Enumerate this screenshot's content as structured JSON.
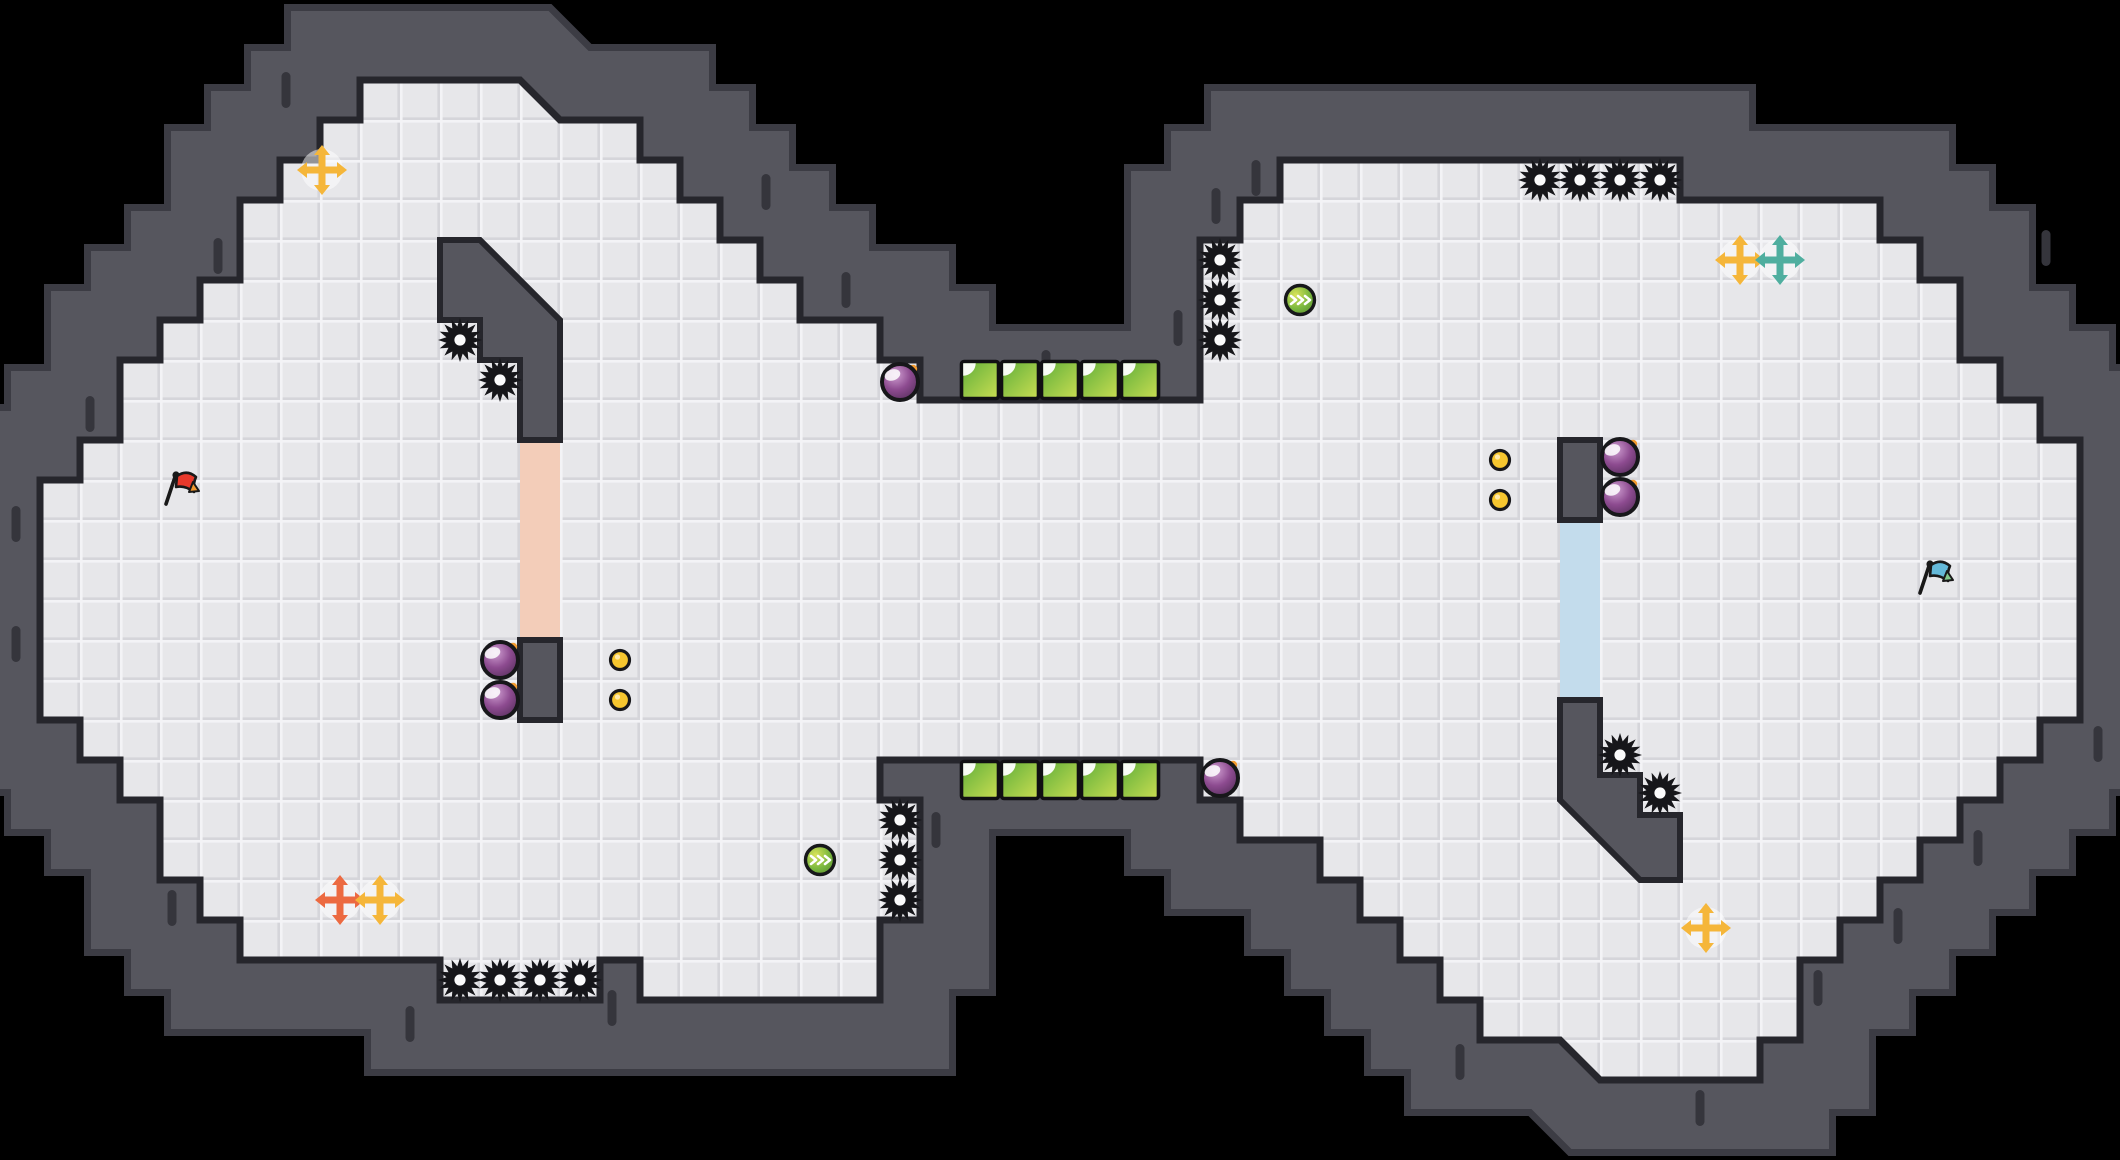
{
  "level": {
    "width": 2120,
    "height": 1160,
    "tile_size": 40,
    "colors": {
      "background": "#000000",
      "wall": "#56565e",
      "wall_rim": "#3c3c44",
      "wall_tick": "#35353c",
      "floor": "#e7e7ea",
      "floor_bevel_light": "#f3f3f6",
      "floor_bevel_dark": "#d5d5da",
      "outline": "#26262c",
      "pink_door": "#f3cdb9",
      "blue_door": "#c3dcec",
      "saw": "#16161a",
      "saw_hole": "#fbfbfc",
      "bomb_body": "#8d4b90",
      "bomb_light": "#cf9ed1",
      "bomb_fuse": "#f49b2e",
      "coin": "#f6c62f",
      "orb_green": "#7ab83e",
      "orb_yellow": "#d9e25a",
      "block_green": "#5fae3a",
      "block_yellow": "#cade52",
      "cross_yellow": "#f5b63a",
      "cross_orange": "#ec6a41",
      "cross_teal": "#4fae9f",
      "flag_red": "#e8392b",
      "flag_red_tip": "#f2982f",
      "flag_blue": "#64b9d9",
      "flag_blue_tip": "#82c98b"
    },
    "floor_polygon": [
      [
        360,
        80
      ],
      [
        520,
        80
      ],
      [
        560,
        120
      ],
      [
        640,
        120
      ],
      [
        640,
        160
      ],
      [
        680,
        160
      ],
      [
        680,
        200
      ],
      [
        720,
        200
      ],
      [
        720,
        240
      ],
      [
        760,
        240
      ],
      [
        760,
        280
      ],
      [
        800,
        280
      ],
      [
        800,
        320
      ],
      [
        880,
        320
      ],
      [
        880,
        360
      ],
      [
        920,
        360
      ],
      [
        920,
        400
      ],
      [
        1200,
        400
      ],
      [
        1200,
        240
      ],
      [
        1240,
        240
      ],
      [
        1240,
        200
      ],
      [
        1280,
        200
      ],
      [
        1280,
        160
      ],
      [
        1680,
        160
      ],
      [
        1680,
        200
      ],
      [
        1880,
        200
      ],
      [
        1880,
        240
      ],
      [
        1920,
        240
      ],
      [
        1920,
        280
      ],
      [
        1960,
        280
      ],
      [
        1960,
        360
      ],
      [
        2000,
        360
      ],
      [
        2000,
        400
      ],
      [
        2040,
        400
      ],
      [
        2040,
        440
      ],
      [
        2080,
        440
      ],
      [
        2080,
        720
      ],
      [
        2040,
        720
      ],
      [
        2040,
        760
      ],
      [
        2000,
        760
      ],
      [
        2000,
        800
      ],
      [
        1960,
        800
      ],
      [
        1960,
        840
      ],
      [
        1920,
        840
      ],
      [
        1920,
        880
      ],
      [
        1880,
        880
      ],
      [
        1880,
        920
      ],
      [
        1840,
        920
      ],
      [
        1840,
        960
      ],
      [
        1800,
        960
      ],
      [
        1800,
        1040
      ],
      [
        1760,
        1040
      ],
      [
        1760,
        1080
      ],
      [
        1600,
        1080
      ],
      [
        1560,
        1040
      ],
      [
        1480,
        1040
      ],
      [
        1480,
        1000
      ],
      [
        1440,
        1000
      ],
      [
        1440,
        960
      ],
      [
        1400,
        960
      ],
      [
        1400,
        920
      ],
      [
        1360,
        920
      ],
      [
        1360,
        880
      ],
      [
        1320,
        880
      ],
      [
        1320,
        840
      ],
      [
        1240,
        840
      ],
      [
        1240,
        800
      ],
      [
        1200,
        800
      ],
      [
        1200,
        760
      ],
      [
        880,
        760
      ],
      [
        880,
        800
      ],
      [
        920,
        800
      ],
      [
        920,
        920
      ],
      [
        880,
        920
      ],
      [
        880,
        1000
      ],
      [
        640,
        1000
      ],
      [
        640,
        960
      ],
      [
        600,
        960
      ],
      [
        600,
        1000
      ],
      [
        440,
        1000
      ],
      [
        440,
        960
      ],
      [
        240,
        960
      ],
      [
        240,
        920
      ],
      [
        200,
        920
      ],
      [
        200,
        880
      ],
      [
        160,
        880
      ],
      [
        160,
        800
      ],
      [
        120,
        800
      ],
      [
        120,
        760
      ],
      [
        80,
        760
      ],
      [
        80,
        720
      ],
      [
        40,
        720
      ],
      [
        40,
        480
      ],
      [
        80,
        480
      ],
      [
        80,
        440
      ],
      [
        120,
        440
      ],
      [
        120,
        360
      ],
      [
        160,
        360
      ],
      [
        160,
        320
      ],
      [
        200,
        320
      ],
      [
        200,
        280
      ],
      [
        240,
        280
      ],
      [
        240,
        200
      ],
      [
        280,
        200
      ],
      [
        280,
        160
      ],
      [
        320,
        160
      ],
      [
        320,
        120
      ],
      [
        360,
        120
      ]
    ],
    "inner_walls": [
      {
        "name": "left-pillar-top",
        "points": [
          [
            440,
            240
          ],
          [
            480,
            240
          ],
          [
            560,
            320
          ],
          [
            560,
            440
          ],
          [
            520,
            440
          ],
          [
            520,
            360
          ],
          [
            480,
            360
          ],
          [
            480,
            320
          ],
          [
            440,
            320
          ]
        ]
      },
      {
        "name": "left-pillar-bottom",
        "points": [
          [
            520,
            640
          ],
          [
            560,
            640
          ],
          [
            560,
            720
          ],
          [
            520,
            720
          ]
        ]
      },
      {
        "name": "right-pillar-top",
        "points": [
          [
            1560,
            440
          ],
          [
            1600,
            440
          ],
          [
            1600,
            520
          ],
          [
            1560,
            520
          ]
        ]
      },
      {
        "name": "right-pillar-bottom",
        "points": [
          [
            1560,
            700
          ],
          [
            1600,
            700
          ],
          [
            1600,
            775
          ],
          [
            1640,
            775
          ],
          [
            1640,
            815
          ],
          [
            1680,
            815
          ],
          [
            1680,
            880
          ],
          [
            1640,
            880
          ],
          [
            1560,
            800
          ]
        ]
      }
    ],
    "door_strips": [
      {
        "name": "pink-door",
        "x": 520,
        "y": 440,
        "w": 40,
        "h": 200,
        "color_key": "pink_door"
      },
      {
        "name": "blue-door",
        "x": 1560,
        "y": 520,
        "w": 40,
        "h": 180,
        "color_key": "blue_door"
      }
    ],
    "saws": [
      [
        460,
        340
      ],
      [
        500,
        380
      ],
      [
        460,
        980
      ],
      [
        500,
        980
      ],
      [
        540,
        980
      ],
      [
        580,
        980
      ],
      [
        900,
        820
      ],
      [
        900,
        860
      ],
      [
        900,
        900
      ],
      [
        1220,
        260
      ],
      [
        1220,
        300
      ],
      [
        1220,
        340
      ],
      [
        1540,
        180
      ],
      [
        1580,
        180
      ],
      [
        1620,
        180
      ],
      [
        1660,
        180
      ],
      [
        1620,
        755
      ],
      [
        1660,
        793
      ]
    ],
    "bombs": [
      [
        500,
        660
      ],
      [
        500,
        700
      ],
      [
        900,
        382
      ],
      [
        1220,
        778
      ],
      [
        1620,
        457
      ],
      [
        1620,
        497
      ]
    ],
    "coins": [
      [
        620,
        660
      ],
      [
        620,
        700
      ],
      [
        1500,
        460
      ],
      [
        1500,
        500
      ]
    ],
    "orbs": [
      [
        1300,
        300
      ],
      [
        820,
        860
      ]
    ],
    "green_blocks": [
      [
        980,
        380
      ],
      [
        1020,
        380
      ],
      [
        1060,
        380
      ],
      [
        1100,
        380
      ],
      [
        1140,
        380
      ],
      [
        980,
        780
      ],
      [
        1020,
        780
      ],
      [
        1060,
        780
      ],
      [
        1100,
        780
      ],
      [
        1140,
        780
      ]
    ],
    "crosses": [
      {
        "x": 322,
        "y": 170,
        "color_key": "cross_yellow"
      },
      {
        "x": 340,
        "y": 900,
        "color_key": "cross_orange"
      },
      {
        "x": 380,
        "y": 900,
        "color_key": "cross_yellow"
      },
      {
        "x": 1740,
        "y": 260,
        "color_key": "cross_yellow"
      },
      {
        "x": 1780,
        "y": 260,
        "color_key": "cross_teal"
      },
      {
        "x": 1706,
        "y": 928,
        "color_key": "cross_yellow"
      }
    ],
    "flags": [
      {
        "name": "red-flag",
        "x": 163,
        "y": 504,
        "body_key": "flag_red",
        "tip_key": "flag_red_tip"
      },
      {
        "name": "blue-flag",
        "x": 1917,
        "y": 593,
        "body_key": "flag_blue",
        "tip_key": "flag_blue_tip"
      }
    ],
    "wall_ticks": [
      [
        286,
        90
      ],
      [
        218,
        256
      ],
      [
        90,
        414
      ],
      [
        16,
        524
      ],
      [
        16,
        644
      ],
      [
        172,
        908
      ],
      [
        410,
        1024
      ],
      [
        612,
        1008
      ],
      [
        766,
        192
      ],
      [
        846,
        290
      ],
      [
        1046,
        368
      ],
      [
        1178,
        328
      ],
      [
        1216,
        206
      ],
      [
        1256,
        178
      ],
      [
        2046,
        248
      ],
      [
        2098,
        744
      ],
      [
        1978,
        848
      ],
      [
        1898,
        926
      ],
      [
        1818,
        988
      ],
      [
        1700,
        1108
      ],
      [
        1460,
        1062
      ],
      [
        936,
        830
      ]
    ]
  }
}
